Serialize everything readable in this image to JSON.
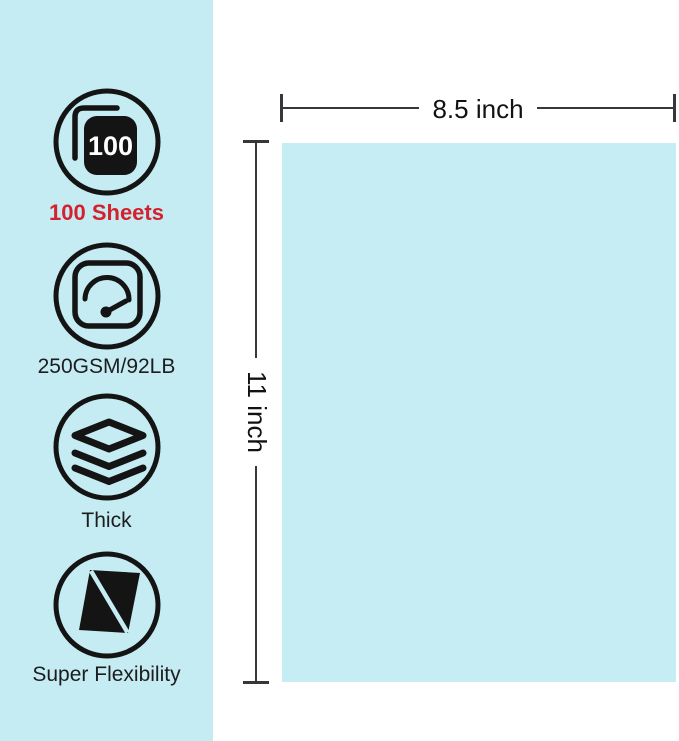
{
  "features": [
    {
      "icon": "sheets-100-icon",
      "badge": "100",
      "label": "100 Sheets"
    },
    {
      "icon": "weight-gauge-icon",
      "label": "250GSM/92LB"
    },
    {
      "icon": "thick-layers-icon",
      "label": "Thick"
    },
    {
      "icon": "flexibility-icon",
      "label": "Super Flexibility"
    }
  ],
  "dimensions": {
    "width_label": "8.5 inch",
    "height_label": "11 inch"
  },
  "colors": {
    "panel_bg": "#c5ecf2",
    "sheet_bg": "#c6edf3",
    "dimension_line": "#38363a",
    "label_text": "#1d1d1f",
    "dimension_text": "#121214",
    "accent_red": "#d4212e",
    "icon_stroke": "#141414",
    "badge_text": "#ffffff"
  }
}
